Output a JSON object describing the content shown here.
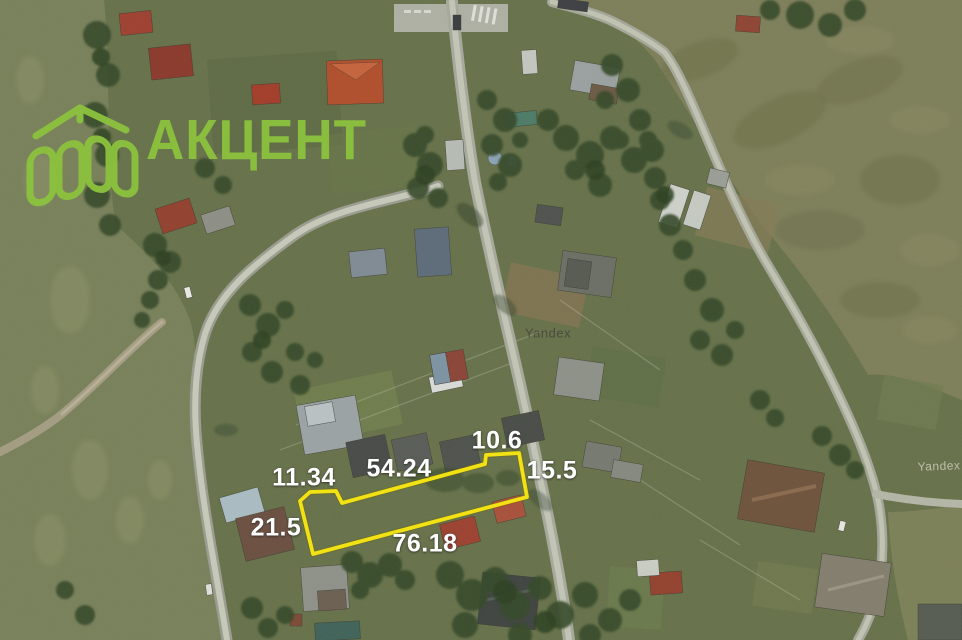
{
  "brand": {
    "name": "АКЦЕНТ",
    "color": "#8cc23e"
  },
  "map": {
    "provider_watermarks": [
      {
        "text": "Yandex"
      },
      {
        "text": "Yandex"
      }
    ]
  },
  "plot": {
    "outline_color": "#f2e214",
    "outline_points": "300,501 310,492 336,491 342,503 485,464 486,455 519,453 527,497 313,554",
    "measurements": [
      {
        "value": "10.6"
      },
      {
        "value": "15.5"
      },
      {
        "value": "54.24"
      },
      {
        "value": "11.34"
      },
      {
        "value": "21.5"
      },
      {
        "value": "76.18"
      }
    ]
  }
}
